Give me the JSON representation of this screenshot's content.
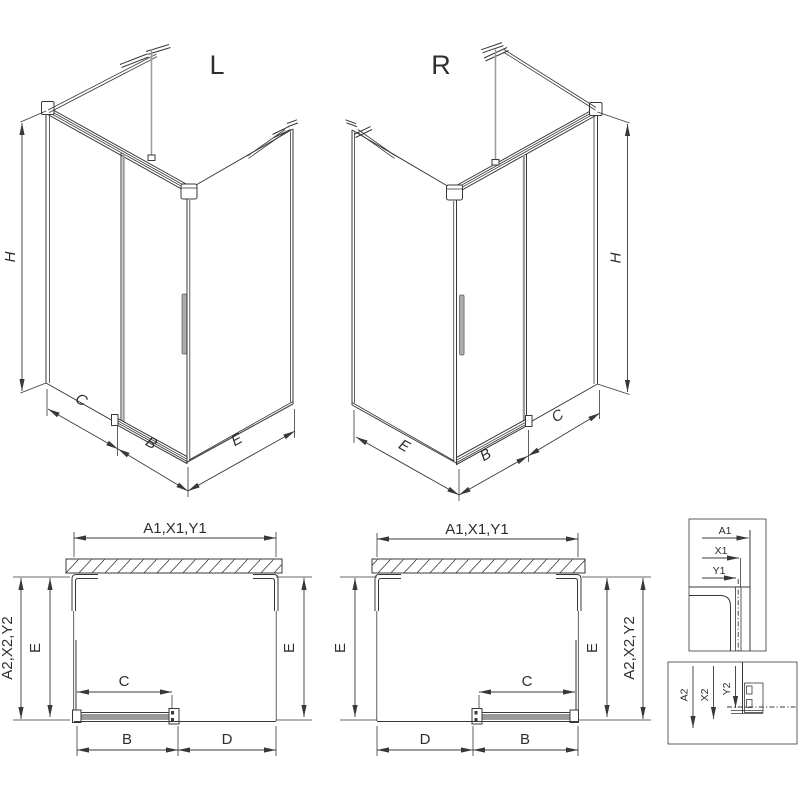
{
  "colors": {
    "line": "#383838",
    "gray": "#9a9a9a",
    "light_gray": "#c9c9c9",
    "background": "#ffffff"
  },
  "iso_left": {
    "label": "L",
    "h": "H",
    "c": "C",
    "b": "B",
    "e": "E"
  },
  "iso_right": {
    "label": "R",
    "h": "H",
    "e": "E",
    "b": "B",
    "c": "C"
  },
  "plan_left": {
    "top": "A1,X1,Y1",
    "outer": "A2,X2,Y2",
    "e_left": "E",
    "e_right": "E",
    "c": "C",
    "b": "B",
    "d": "D"
  },
  "plan_right": {
    "top": "A1,X1,Y1",
    "outer": "A2,X2,Y2",
    "e_left": "E",
    "e_right": "E",
    "c": "C",
    "d": "D",
    "b": "B"
  },
  "detail_top": {
    "a1": "A1",
    "x1": "X1",
    "y1": "Y1"
  },
  "detail_bottom": {
    "a2": "A2",
    "x2": "X2",
    "y2": "Y2"
  }
}
